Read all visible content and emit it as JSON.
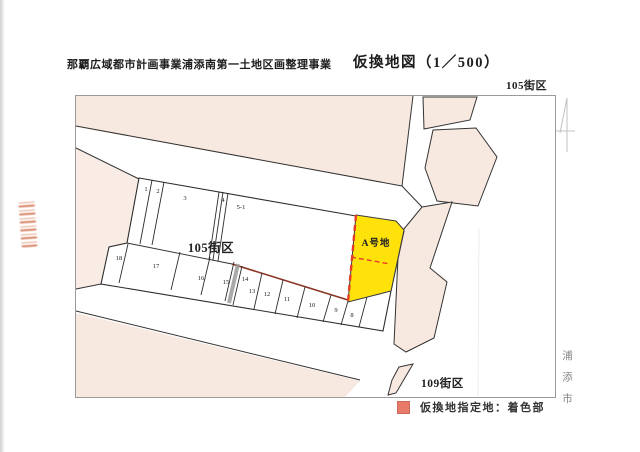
{
  "header": {
    "project_title": "那覇広域都市計画事業浦添南第一土地区画整理事業",
    "map_title": "仮換地図（1／500）",
    "block_ref_top_right": "105街区"
  },
  "map": {
    "block_105_label": "105街区",
    "block_109_label": "109街区",
    "parcel_a_label": "A号地",
    "parcels": [
      "1",
      "2",
      "3",
      "4",
      "5-1",
      "18",
      "17",
      "16",
      "15",
      "14",
      "13",
      "12",
      "11",
      "10",
      "9",
      "8"
    ],
    "city_margin_label": "浦添市"
  },
  "legend": {
    "text": "仮換地指定地：着色部",
    "swatch_color": "#e87a6a"
  },
  "colors": {
    "block_fill": "#f8e9e0",
    "highlight_parcel": "#ffe20a",
    "designation_line": "#e83b28",
    "stamp": "#cd5f37"
  }
}
